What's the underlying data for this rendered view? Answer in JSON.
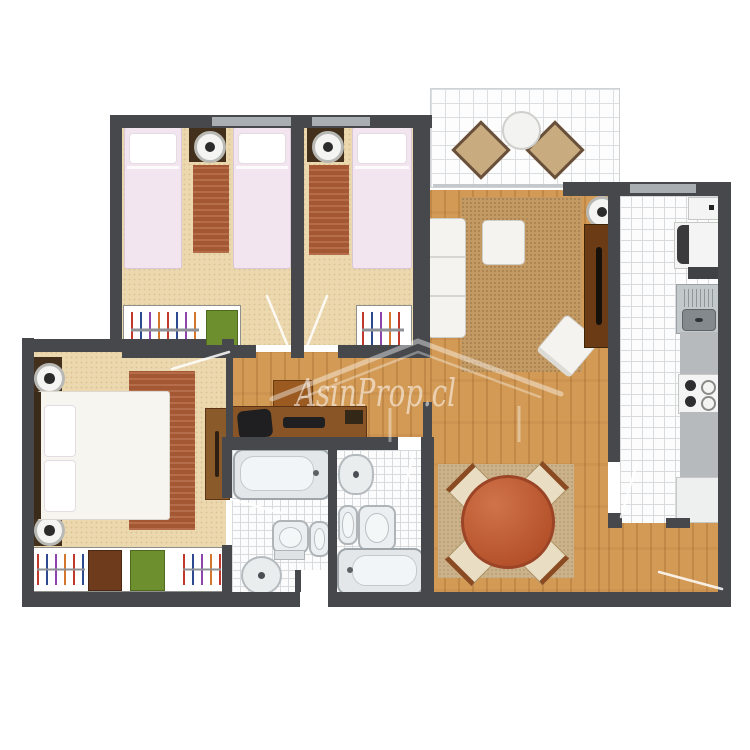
{
  "watermark": {
    "text": "AsinProp.cl"
  },
  "palette": {
    "wall": "#46484c",
    "window": "#a9aeb2",
    "carpet": "#ebd8ae",
    "wood": "#d39a55",
    "tile_bg": "#fcfcfc",
    "tile_line": "#d7dbde",
    "rug_terracotta": "#ad5c36",
    "rug_living": "#c39a63",
    "rug_dining": "#ccb28b",
    "bed_linen_pink": "#f2e5f0",
    "furniture_white": "#f4f3ef",
    "nightstand_brown": "#42301c",
    "desk_brown": "#8a5526",
    "dark_object": "#1f1f21",
    "green_box": "#6d8f2e",
    "storage_brown": "#6e3b1d",
    "dining_table": "#bf5f38",
    "chair_cream": "#e9ddc4",
    "chair_back_brown": "#8a4a22",
    "balcony_chair": "#c9ab80",
    "counter_gray": "#b7babc",
    "steel_gray": "#c3c8cb"
  },
  "rooms": [
    {
      "name": "bedroom-1",
      "floor": "carpet",
      "furniture": [
        "single-bed",
        "single-bed",
        "nightstand-lamp",
        "rug",
        "closet-hangers",
        "storage-box-green"
      ]
    },
    {
      "name": "bedroom-2",
      "floor": "carpet",
      "furniture": [
        "single-bed",
        "nightstand-lamp",
        "rug",
        "closet-hangers"
      ]
    },
    {
      "name": "master-bedroom",
      "floor": "carpet",
      "furniture": [
        "double-bed",
        "nightstand-lamp",
        "nightstand-lamp",
        "rug",
        "dresser",
        "closet-hangers",
        "storage-box-brown",
        "storage-box-green"
      ]
    },
    {
      "name": "living-room",
      "floor": "wood",
      "furniture": [
        "corner-sofa",
        "ottoman",
        "armchair",
        "area-rug",
        "tv-cabinet",
        "floor-lamp"
      ]
    },
    {
      "name": "dining-area",
      "floor": "wood",
      "furniture": [
        "round-table",
        "chair",
        "chair",
        "chair",
        "chair",
        "rug"
      ]
    },
    {
      "name": "study-nook",
      "floor": "wood",
      "furniture": [
        "desk",
        "office-chair",
        "laptop",
        "keyboard"
      ]
    },
    {
      "name": "kitchen",
      "floor": "tile",
      "furniture": [
        "upper-cabinet",
        "refrigerator",
        "shelf",
        "sink",
        "counter",
        "stove",
        "counter",
        "cabinet"
      ]
    },
    {
      "name": "bathroom-1",
      "floor": "tile",
      "furniture": [
        "bathtub",
        "toilet",
        "bidet",
        "round-sink"
      ]
    },
    {
      "name": "bathroom-2",
      "floor": "tile",
      "furniture": [
        "round-sink",
        "bidet",
        "toilet",
        "bathtub"
      ]
    },
    {
      "name": "balcony",
      "floor": "tile",
      "furniture": [
        "round-table",
        "lounge-chair",
        "lounge-chair"
      ]
    }
  ]
}
